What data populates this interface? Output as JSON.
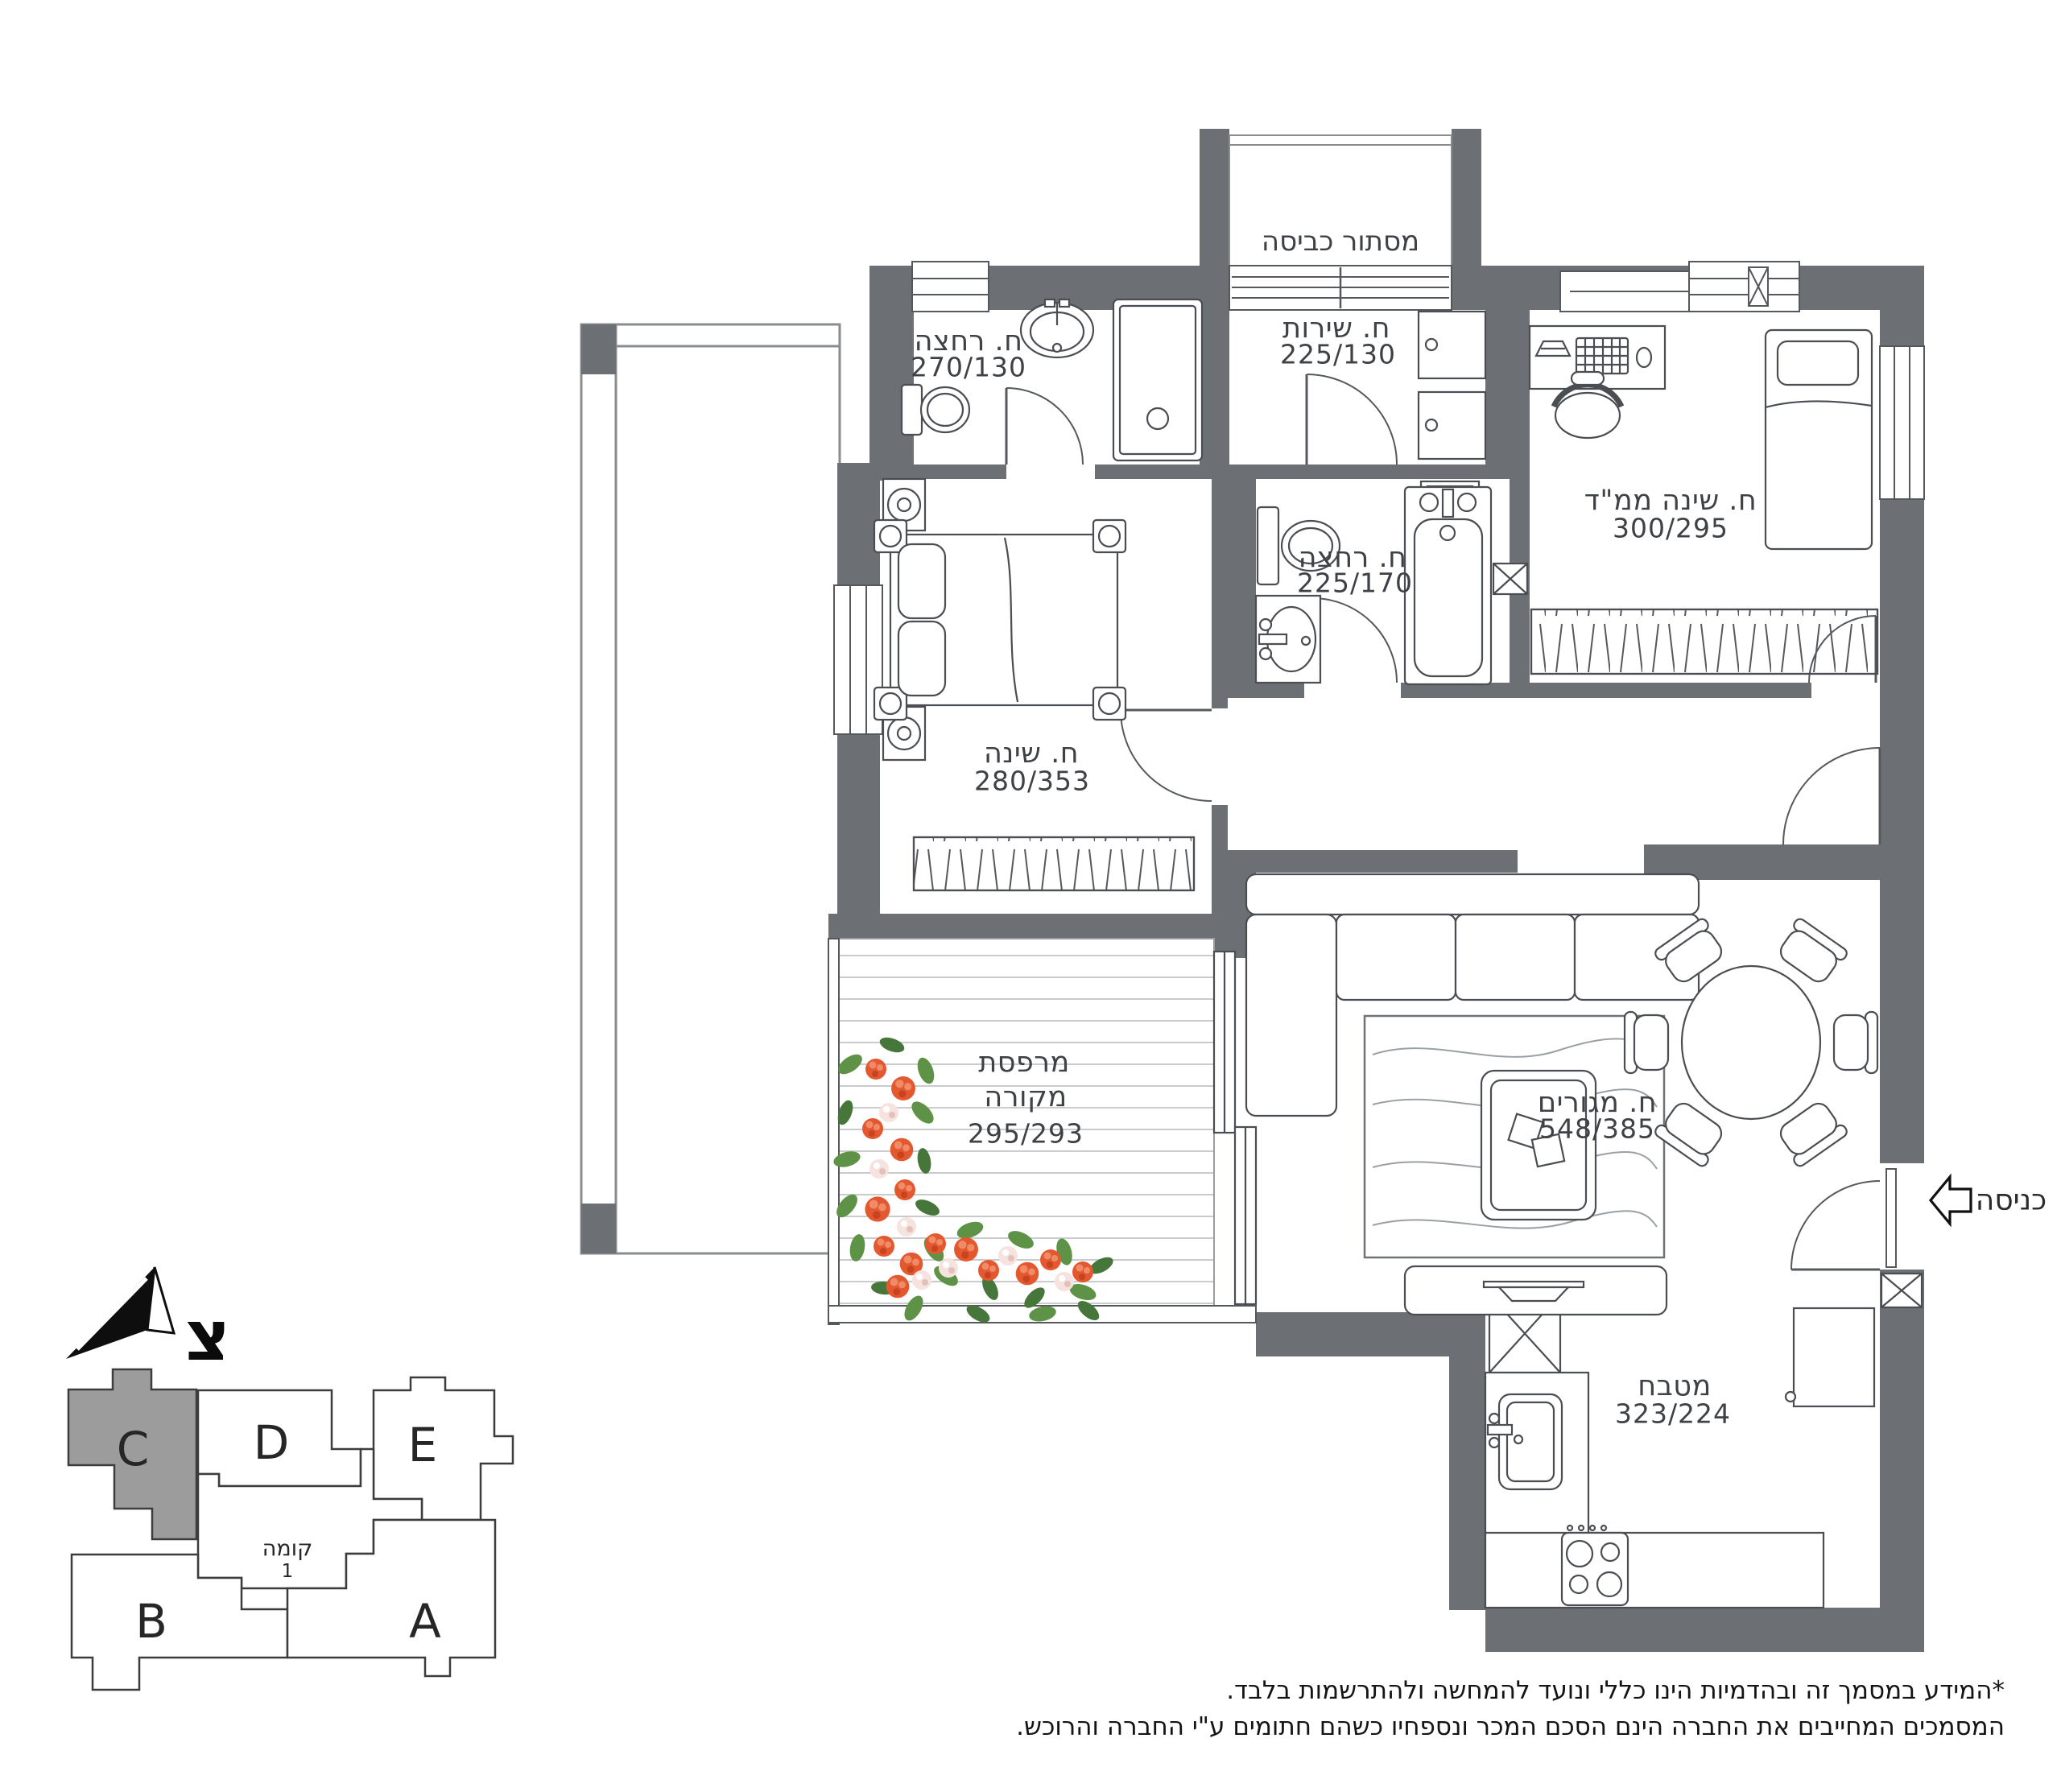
{
  "rooms": {
    "laundry": {
      "name": "מסתור כביסה"
    },
    "bath_top": {
      "name": "ח. רחצה",
      "dims": "270/130"
    },
    "wc": {
      "name": "ח. שירות",
      "dims": "225/130"
    },
    "mamad": {
      "name": "ח. שינה ממ\"ד",
      "dims": "300/295"
    },
    "bath_mid": {
      "name": "ח. רחצה",
      "dims": "225/170"
    },
    "bedroom": {
      "name": "ח. שינה",
      "dims": "280/353"
    },
    "balcony": {
      "name1": "מרפסת",
      "name2": "מקורה",
      "dims": "295/293"
    },
    "living": {
      "name": "ח. מגורים",
      "dims": "548/385"
    },
    "kitchen": {
      "name": "מטבח",
      "dims": "323/224"
    }
  },
  "entrance": {
    "label": "כניסה"
  },
  "north": {
    "letter": "צ"
  },
  "keyplan": {
    "units": {
      "c": "C",
      "d": "D",
      "e": "E",
      "b": "B",
      "a": "A"
    },
    "highlighted_unit": "C",
    "floor_word": "קומה",
    "floor_number": "1"
  },
  "disclaimer": {
    "line1": "*המידע במסמך זה ובהדמיות הינו כללי ונועד להמחשה ולהתרשמות בלבד.",
    "line2": "המסמכים המחייבים את החברה הינם הסכם המכר ונספחיו כשהם חתומים ע\"י החברה והרוכש."
  },
  "colors": {
    "wall": "#6c6f74",
    "line": "#4a4d52",
    "deck_stripe": "#c9cbcd",
    "flower_orange": "#e4582f",
    "flower_white": "#f6e3df",
    "leaf_green": "#5d9247",
    "highlight_unit": "#9c9c9c"
  }
}
